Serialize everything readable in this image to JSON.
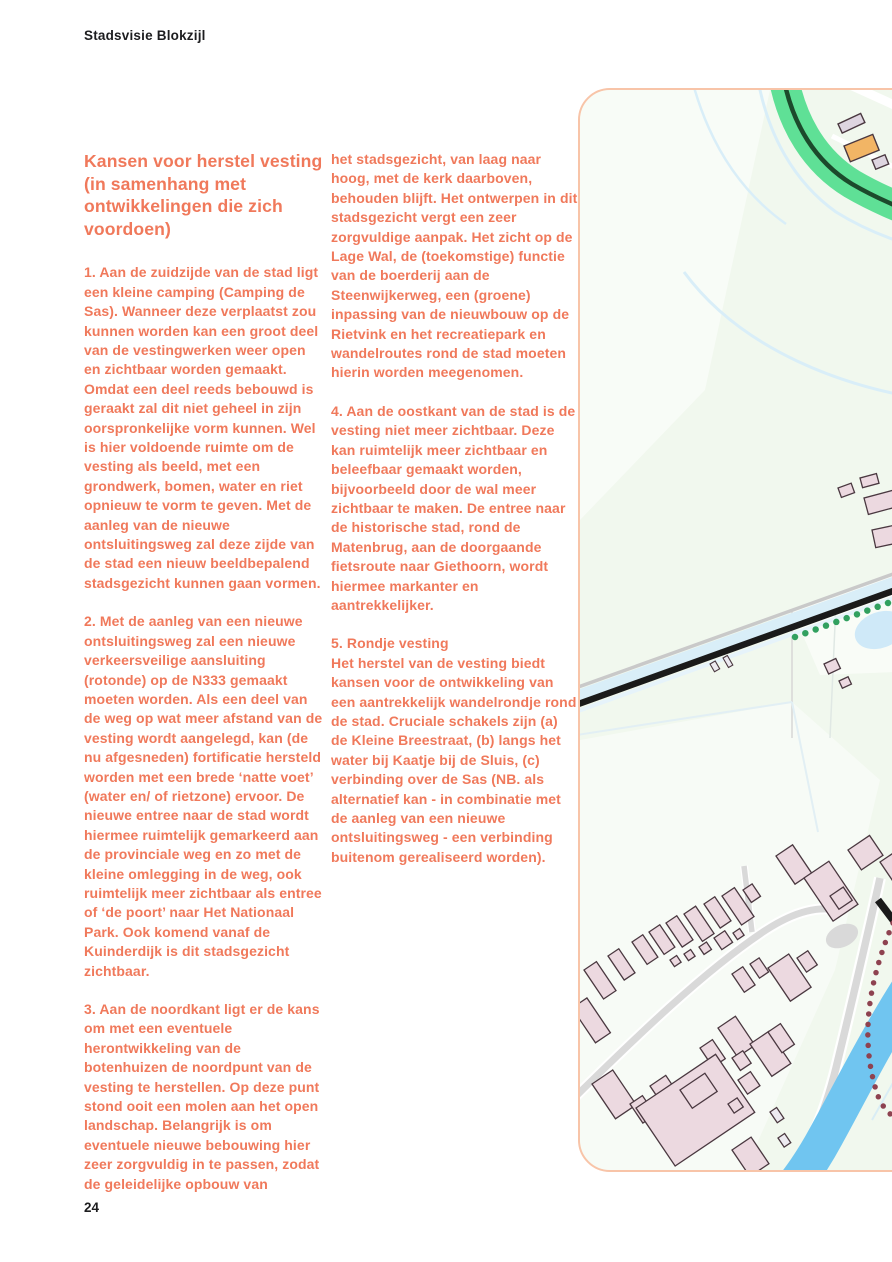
{
  "theme": {
    "body_text": "#f0795b",
    "ink": "#1d1d1f"
  },
  "page": {
    "header": "Stadsvisie Blokzijl",
    "page_number": "24"
  },
  "article": {
    "heading": "Kansen voor herstel vesting (in samenhang met ontwikkelingen die zich voordoen)",
    "columns": [
      {
        "paragraphs": [
          "1. Aan de zuidzijde van de stad ligt een kleine camping (Camping de Sas). Wanneer deze verplaatst zou kunnen worden kan een groot deel van de vestingwerken weer open en zichtbaar worden gemaakt. Omdat een deel reeds bebouwd is geraakt zal dit niet geheel in zijn oorspronkelijke vorm kunnen. Wel is hier voldoende ruimte om de vesting als beeld, met een grondwerk, bomen, water en riet opnieuw te vorm te geven. Met de aanleg van de nieuwe ontsluitingsweg zal deze zijde van de stad een nieuw beeldbepalend stadsgezicht kunnen gaan vormen.",
          "2. Met de aanleg van een nieuwe ontsluitingsweg zal een nieuwe verkeersveilige aansluiting (rotonde) op de N333 gemaakt moeten worden. Als een deel van de weg op wat meer afstand van de vesting wordt aangelegd, kan (de nu afgesneden) fortificatie hersteld worden met een brede ‘natte voet’ (water en/ of rietzone) ervoor. De nieuwe entree naar de stad wordt hiermee ruimtelijk gemarkeerd aan de provinciale weg en zo met de kleine omlegging in de weg, ook ruimtelijk meer zichtbaar als entree of ‘de poort’ naar Het Nationaal Park. Ook komend vanaf de Kuinderdijk is dit stadsgezicht zichtbaar.",
          "3. Aan de noordkant ligt er de kans om met een eventuele herontwikkeling van de botenhuizen de noordpunt van de vesting te herstellen. Op deze punt stond ooit een molen aan het open landschap. Belangrijk is om eventuele nieuwe bebouwing hier zeer zorgvuldig in te passen, zodat de geleidelijke opbouw van"
        ]
      },
      {
        "paragraphs": [
          "het stadsgezicht, van laag naar hoog, met de kerk daarboven, behouden blijft. Het ontwerpen in dit stadsgezicht vergt een zeer zorgvuldige aanpak. Het zicht op de Lage Wal, de (toekomstige) functie van de boerderij aan de Steenwijkerweg, een (groene) inpassing van de nieuwbouw op de Rietvink en het recreatiepark en wandelroutes rond de stad moeten hierin worden meegenomen.",
          "4. Aan de oostkant van de stad is de vesting niet meer zichtbaar. Deze kan ruimtelijk meer zichtbaar en beleefbaar gemaakt worden, bijvoorbeeld door de wal meer zichtbaar te maken. De entree naar de historische stad, rond de Matenbrug, aan de doorgaande fietsroute naar Giethoorn, wordt hiermee markanter en aantrekkelijker.",
          "5. Rondje vesting\nHet herstel van de vesting biedt kansen voor de ontwikkeling van een aantrekkelijk wandelrondje rond de stad. Cruciale schakels zijn (a) de Kleine Breestraat, (b) langs het water bij Kaatje bij de Sluis, (c) verbinding over de Sas (NB. als alternatief kan - in combinatie met de aanleg van een nieuwe ontsluitingsweg - een verbinding buitenom gerealiseerd worden)."
        ]
      }
    ]
  },
  "map": {
    "caption": "Topographic map detail east of Blokzijl with N333, canal and industrial area",
    "features": {
      "map_background": "#f1f8ee",
      "frame_border": "#f8c4a8",
      "highway_green_verge": "#5fe096",
      "highway_line": "#1c4a2c",
      "main_road": "#1a1a1a",
      "minor_road": "#d9d9d9",
      "water_canal": "#70c5f0",
      "water_ditch": "#d9eef8",
      "building_fill": "#ecd9e0",
      "building_outline": "#4a3840",
      "building_grey": "#ded5e0",
      "highlight_building": "#f2b565",
      "walking_route_dots": "#31a05f",
      "alt_route_dots": "#8e4250"
    }
  }
}
